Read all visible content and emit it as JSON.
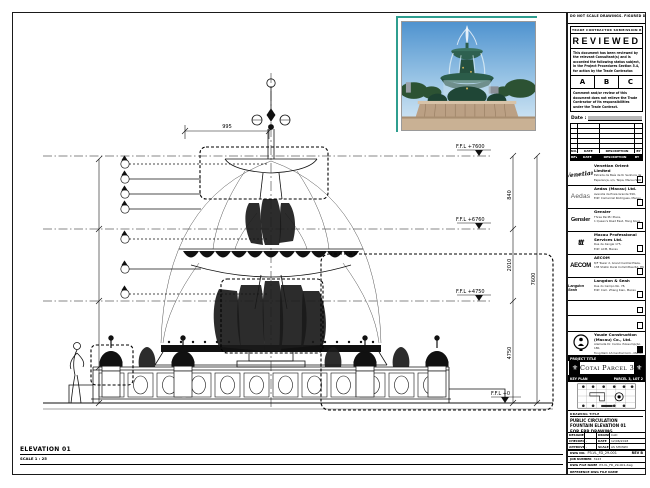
{
  "note": "DO NOT SCALE DRAWINGS. FIGURED DIMENSIONS ONLY. VERIFY ALL DIMENSIONS ON SITE.",
  "stamp": {
    "header": "TRADE CONTRACTOR SUBMISSION REVIEW",
    "title": "REVIEWED",
    "body1": "This document has been reviewed by the relevant Consultant(s) and is accorded the following status subject, in the Project Procedures Section 5.4, for action by the Trade Contractor.",
    "options": [
      "A",
      "B",
      "C"
    ],
    "body2": "Comment and/or review of this document does not relieve the Trade Contractor of its responsibilities under the Trade Contract.",
    "date_label": "Date :"
  },
  "revisions": {
    "header": [
      "NO.",
      "DATE",
      "DESCRIPTION",
      "BY"
    ],
    "footer": [
      "REV",
      "DATE",
      "DESCRIPTION",
      "BY"
    ]
  },
  "consultants": [
    {
      "logo": "Venetian",
      "name": "Venetian Orient Limited",
      "addr1": "Estrada da Baía de N. Senhora da",
      "addr2": "Esperança, s/n, Taipa, Macau SAR"
    },
    {
      "logo": "Aedas",
      "name": "Aedas (Macau) Ltd.",
      "addr1": "Avenida da Praia Grande 599,",
      "addr2": "Edif. Comercial Rodrigues, Macau"
    },
    {
      "logo": "Gensler",
      "name": "Gensler",
      "addr1": "Three Pacific Place,",
      "addr2": "1 Queen's Road East, Hong Kong"
    },
    {
      "logo": "ttt",
      "name": "Macau Professional Services Ltd.",
      "addr1": "Rua de Xangai 175,",
      "addr2": "Edif. ACM, Macau"
    },
    {
      "logo": "AECOM",
      "name": "AECOM",
      "addr1": "8/F Tower 2, Grand Central Plaza,",
      "addr2": "138 Shatin Rural Committee Rd, HK"
    },
    {
      "logo": "Langdon Seah",
      "name": "Langdon & Seah",
      "addr1": "Rua do Campo No. 78,",
      "addr2": "Edif. Com. Zhang Kian, Macau"
    }
  ],
  "contractor": {
    "name": "Youde Construction (Macau) Co., Ltd.",
    "addr1": "Alameda Dr. Carlos d'Assumpção 180,",
    "addr2": "Tong Nam Ah Central Com., Macau"
  },
  "project": {
    "label": "PROJECT TITLE",
    "name": "Cotai Parcel 3",
    "fleur_icon": "⚜"
  },
  "keyplan": {
    "label": "KEY PLAN",
    "right": "PARCEL 3, LOT 2"
  },
  "drawing_title": {
    "label": "DRAWING TITLE",
    "line1": "PUBLIC CIRCULATION",
    "line2": "FOUNTAIN ELEVATION 01",
    "line3": "FOR FRP DRAWING"
  },
  "credits": {
    "designed_label": "DESIGNED",
    "designed": "",
    "drawn_label": "DRAWN",
    "drawn": "CAD",
    "checked_label": "CHECKED",
    "checked": "-",
    "date_label": "DATE",
    "date": "12/06/2018",
    "approved_label": "APPROVED",
    "approved": "-",
    "scale_label": "SCALE",
    "scale": "AS SHOWN"
  },
  "dwg": {
    "no_label": "DWG NO.",
    "no": "P3-VL_FD_29-001",
    "rev": "REV B",
    "job_label": "JOB NUMBER",
    "job": "3123",
    "file_label": "DWG FILE NAME",
    "file": "P3-VL_FD_29-001.dwg",
    "ref_label": "REFERENCE DWG FILE NAME",
    "ref": ""
  },
  "elevation": {
    "label": "ELEVATION 01",
    "scale": "SCALE 1 : 25"
  },
  "annotations": {
    "levels": [
      "F.F.L +7600",
      "F.F.L +6760",
      "F.F.L +4750",
      "F.F.L +0"
    ],
    "dims": {
      "seg1": "840",
      "seg2": "2010",
      "seg3": "4750",
      "total": "7600",
      "top": "995"
    }
  },
  "colors": {
    "line": "#111111",
    "stamp_teal": "#2f9e8f",
    "sky": "#4f93cf",
    "bronze_green": "#2b5c49",
    "stone": "#bba084"
  }
}
